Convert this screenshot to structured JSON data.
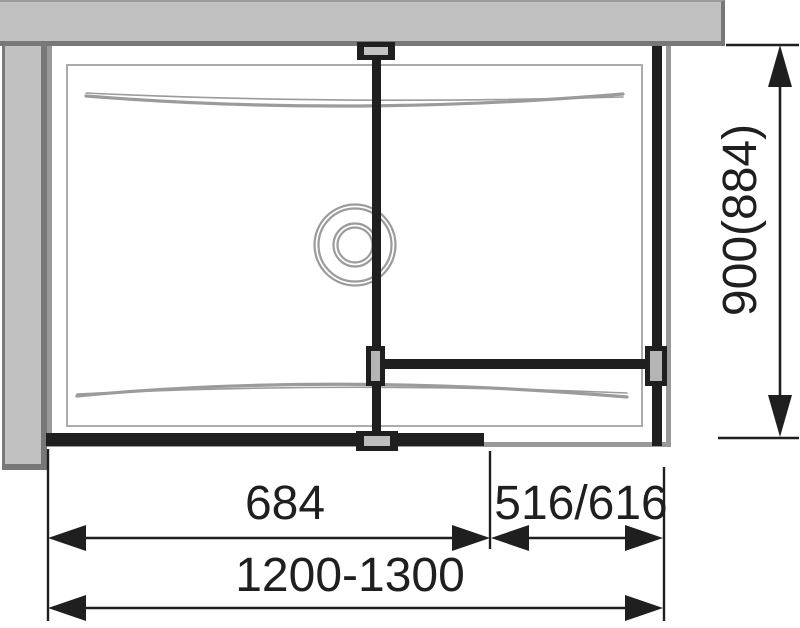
{
  "diagram": {
    "title": "shower-enclosure-top-view",
    "dimensions": {
      "door_width": "684",
      "side_panel_width": "516/616",
      "overall_width": "1200-1300",
      "depth": "900(884)"
    },
    "colors": {
      "wall_fill": "#c1c1c1",
      "wall_edge": "#787878",
      "tray_edge": "#999999",
      "texture_line": "#9b9b9b",
      "profile_black": "#1f1f1f"
    }
  }
}
